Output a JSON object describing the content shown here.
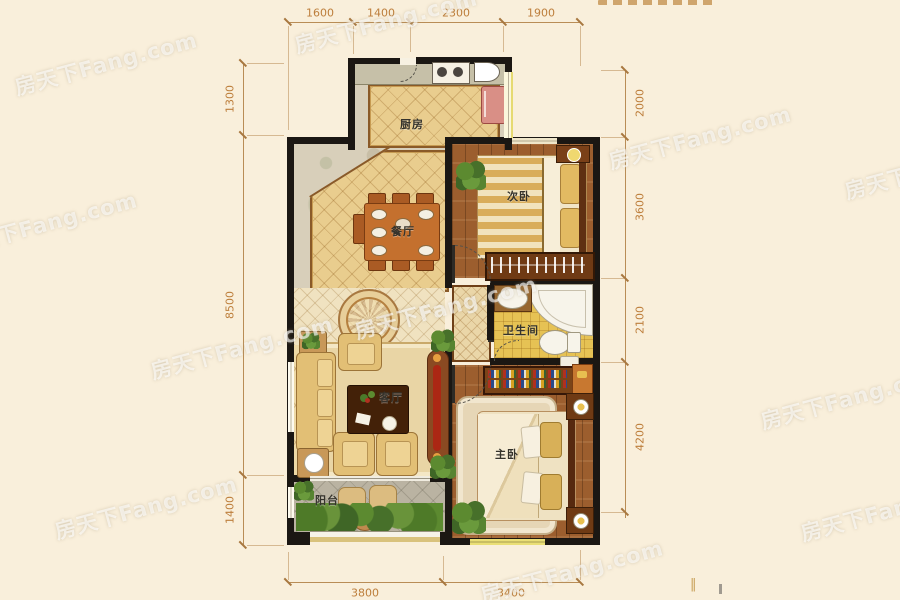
{
  "watermark": {
    "text": "房天下Fang.com"
  },
  "rooms": {
    "kitchen": {
      "label": "厨房"
    },
    "dining": {
      "label": "餐厅"
    },
    "living": {
      "label": "客厅"
    },
    "balcony": {
      "label": "阳台"
    },
    "bedroom2": {
      "label": "次卧"
    },
    "bathroom": {
      "label": "卫生间"
    },
    "master": {
      "label": "主卧"
    }
  },
  "dims": {
    "top": [
      "1600",
      "1400",
      "2300",
      "1900"
    ],
    "left": [
      "1300",
      "8500",
      "1400"
    ],
    "right": [
      "2000",
      "3600",
      "2100",
      "4200"
    ],
    "bottom": [
      "3800",
      "3400"
    ]
  },
  "footer_marks": "‖",
  "colors": {
    "background": "#f9efdb",
    "wall": "#1b1713",
    "dimension_text": "#bd7e3b",
    "gold_tile": "#e9cd8e",
    "wood_floor": "#9c5e2e",
    "bath_tile": "#e6c254",
    "balcony_stone": "#bab3a2"
  }
}
